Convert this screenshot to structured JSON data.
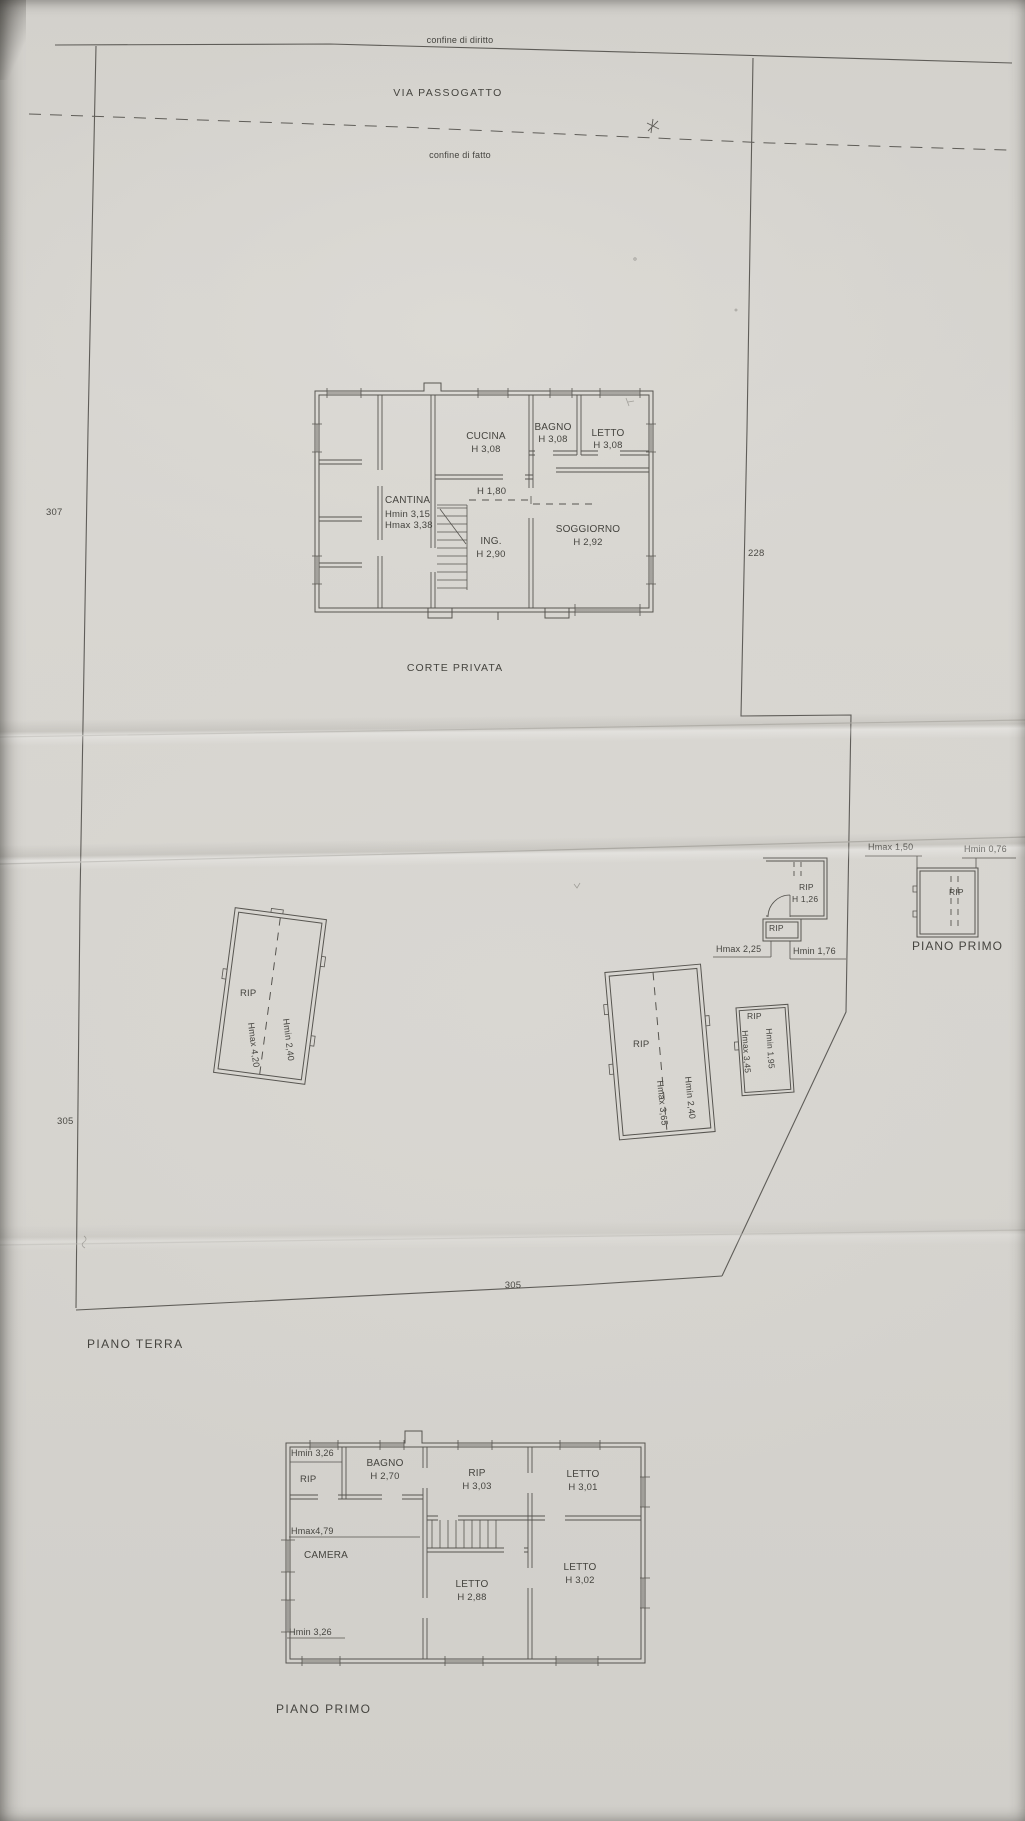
{
  "site_plan": {
    "legal_boundary": "confine di diritto",
    "road": "VIA PASSOGATTO",
    "de_facto_boundary": "confine di fatto",
    "courtyard": "CORTE PRIVATA",
    "title": "PIANO TERRA",
    "dims": {
      "west": "307",
      "east": "228",
      "west_lower": "305",
      "south": "305"
    }
  },
  "ground_floor": {
    "cucina": {
      "name": "CUCINA",
      "height": "H 3,08"
    },
    "bagno": {
      "name": "BAGNO",
      "height": "H 3,08"
    },
    "letto": {
      "name": "LETTO",
      "height": "H 3,08"
    },
    "cantina": {
      "name": "CANTINA",
      "hmin": "Hmin 3,15",
      "hmax": "Hmax 3,38"
    },
    "understair": {
      "height": "H 1,80"
    },
    "ingresso": {
      "name": "ING.",
      "height": "H 2,90"
    },
    "soggiorno": {
      "name": "SOGGIORNO",
      "height": "H 2,92"
    }
  },
  "annexes": {
    "rip_west": {
      "name": "RIP",
      "hmax": "Hmax 4,20",
      "hmin": "Hmin 2,40"
    },
    "rip_central": {
      "name": "RIP",
      "hmax": "Hmax 3,65",
      "hmin": "Hmin 2,40"
    },
    "rip_small": {
      "name": "RIP",
      "hmax": "Hmax 3,45",
      "hmin": "Hmin 1,95"
    },
    "rip_north": {
      "name": "RIP",
      "height": "H 1,26"
    },
    "rip_north_annex": {
      "name": "RIP",
      "hmax": "Hmax 2,25",
      "hmin": "Hmin 1,76"
    }
  },
  "rip_first_floor_sketch": {
    "name": "RIP",
    "hmax": "Hmax 1,50",
    "hmin": "Hmin 0,76",
    "title": "PIANO PRIMO"
  },
  "first_floor": {
    "title": "PIANO PRIMO",
    "rip_nw": {
      "name": "RIP",
      "hmin": "Hmin 3,26"
    },
    "bagno": {
      "name": "BAGNO",
      "height": "H 2,70"
    },
    "rip_center": {
      "name": "RIP",
      "height": "H 3,03"
    },
    "letto_ne": {
      "name": "LETTO",
      "height": "H 3,01"
    },
    "camera": {
      "name": "CAMERA",
      "hmax": "Hmax4,79",
      "hmin": "Hmin 3,26"
    },
    "letto_center": {
      "name": "LETTO",
      "height": "H 2,88"
    },
    "letto_se": {
      "name": "LETTO",
      "height": "H 3,02"
    }
  }
}
